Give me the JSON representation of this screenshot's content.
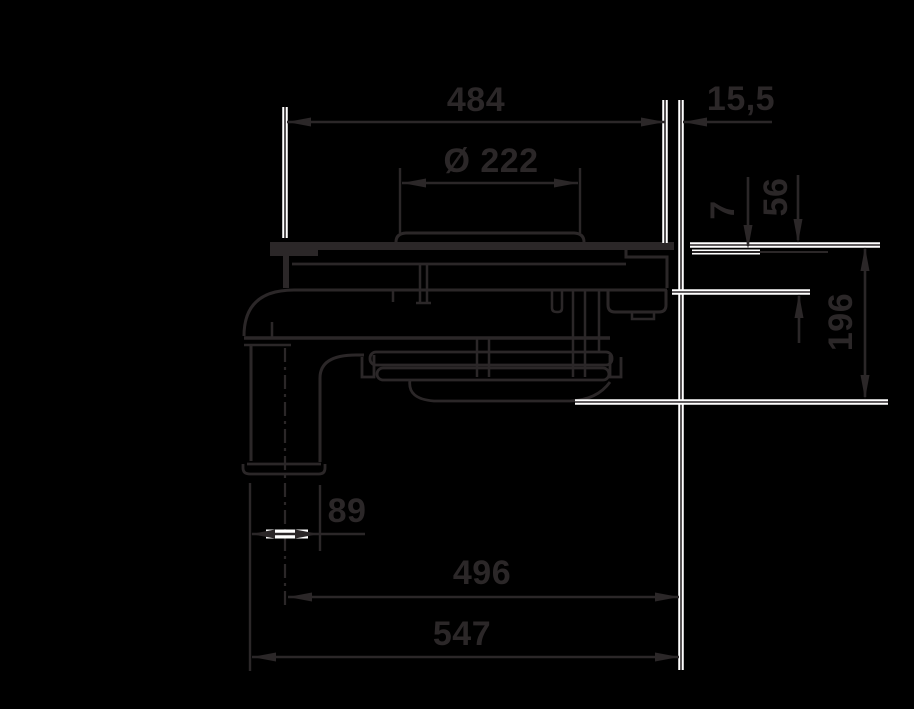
{
  "drawing": {
    "title": "drain-trap-technical-drawing",
    "dimensions": {
      "width_top": "484",
      "edge_offset": "15,5",
      "grate_diameter": "Ø 222",
      "flange_thickness": "7",
      "body_height": "56",
      "total_height": "196",
      "outlet_diameter": "89",
      "length_to_outlet_center": "496",
      "total_length": "547"
    },
    "colors": {
      "ink": "#2b2728",
      "halo": "#ffffff",
      "background": "#000000"
    }
  }
}
